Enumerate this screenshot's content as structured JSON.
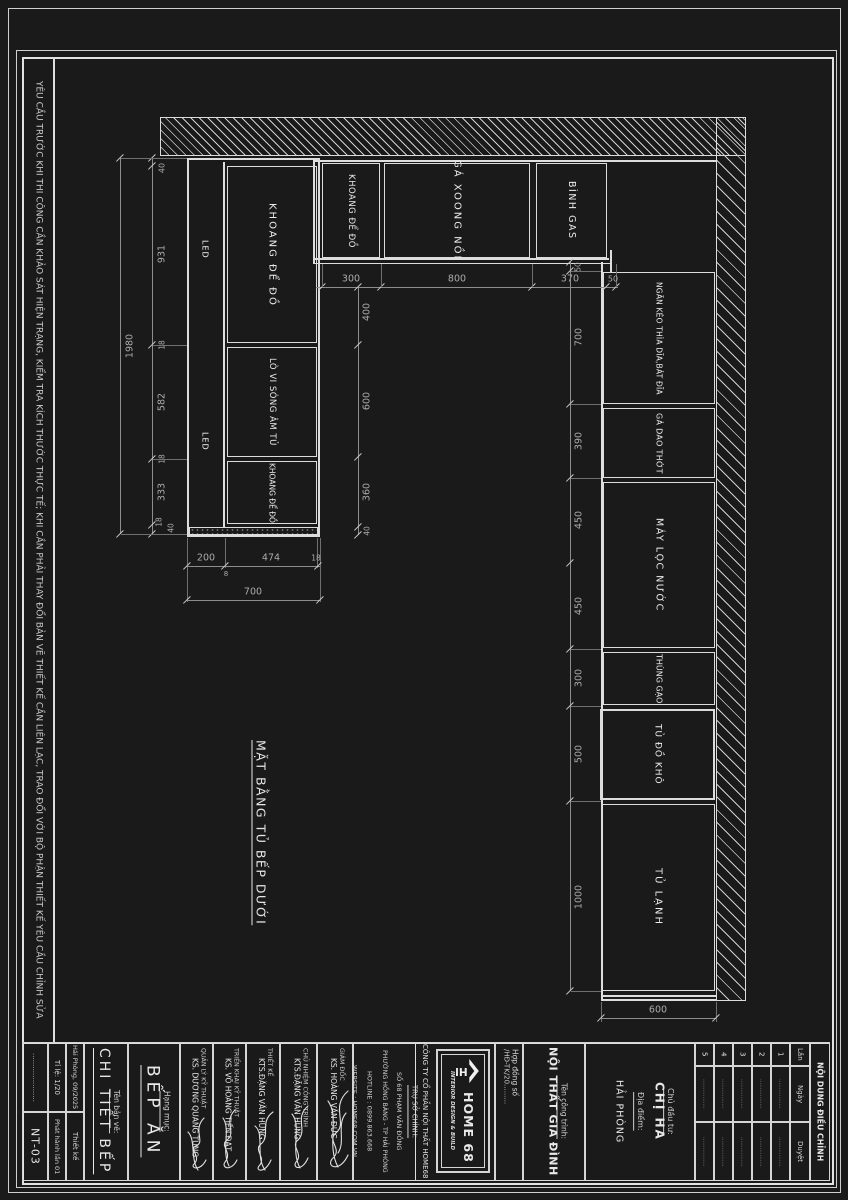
{
  "sheet": {
    "margin_note": "YÊU CẦU TRƯỚC KHI THI CÔNG CẦN KHẢO SÁT HIỆN TRẠNG, KIỂM TRA  KÍCH THƯỚC THỰC TẾ; KHI CẦN PHẢI THAY ĐỔI BẢN VẼ THIẾT KẾ CẦN LIÊN LẠC, TRAO ĐỔI VỚI BỘ PHẬN THIẾT KẾ YÊU CẦU CHỈNH SỬA",
    "drawing_title": "MẶT BẰNG TỦ BẾP DƯỚI"
  },
  "cabinets": {
    "top_row": [
      "KHOANG ĐỂ ĐỒ",
      "GÁ XOONG NỒI",
      "BÌNH GAS"
    ],
    "left_block": [
      "KHOANG ĐỂ ĐỒ",
      "LÒ VI SÓNG ÂM TỦ",
      "KHOANG ĐỂ ĐỒ"
    ],
    "led": "LED",
    "right_col": [
      "NGĂN KÉO THÌA DĨA,BÁT ĐĨA",
      "GÁ DAO THỚT",
      "MÁY LỌC NƯỚC",
      "THÙNG GẠO",
      "TỦ ĐỒ KHÔ",
      "TỦ LẠNH"
    ]
  },
  "dims": {
    "top": [
      "300",
      "800",
      "370",
      "50"
    ],
    "left_total": "1980",
    "left_chain": [
      "40",
      "931",
      "18",
      "582",
      "18",
      "333",
      "18",
      "40"
    ],
    "mid_chain": [
      "400",
      "600",
      "360",
      "40"
    ],
    "right_chain": [
      "50",
      "700",
      "390",
      "450",
      "450",
      "300",
      "500",
      "1000"
    ],
    "left_bottom": [
      "200",
      "8",
      "474",
      "18"
    ],
    "left_bottom_total": "700",
    "bottom_right": "600"
  },
  "titleblock": {
    "sheet_no": "NT-03",
    "dots_cell": "......................",
    "scale": "Tỉ lệ: 1/20",
    "issue": "Phát hành lần 01",
    "place_date": "Hải Phòng, 09/2025",
    "design_word": "Thiết kế",
    "drawing_name_label": "Tên bản vẽ:",
    "drawing_name": "CHI TIẾT BẾP",
    "category_label": "Hạng mục:",
    "category": "BẾP ĂN",
    "roles": [
      {
        "role": "QUẢN LÝ KỸ THUẬT",
        "name": "KS. DƯƠNG QUANG TÙNG"
      },
      {
        "role": "TRIỂN KHAI KỸ THUẬT",
        "name": "KS. VÕ HOÀNG TIẾN ĐẠT"
      },
      {
        "role": "THIẾT KẾ",
        "name": "KTS.ĐẶNG VĂN HÙNG"
      },
      {
        "role": "CHỦ NHIỆM CÔNG TRÌNH",
        "name": "KTS.ĐẶNG VĂN HÙNG"
      },
      {
        "role": "GIÁM ĐỐC",
        "name": "KS. HOÀNG VĂN ĐỨC"
      }
    ],
    "company": {
      "hq_label": "TRỤ SỞ CHÍNH:",
      "address1": "SỐ 68 PHẠM VĂN ĐỒNG",
      "address2": "PHƯỜNG HỒNG BÀNG - TP HẢI PHÒNG",
      "hotline": "HOTLINE : 0899.863.668",
      "website": "WEBSITE : HOME68.COM.VN",
      "name": "CÔNG TY CỔ PHẦN NỘI THẤT HOME68",
      "logo_mark": "HN",
      "logo_text": "HOME 68",
      "logo_sub": "INTERIOR DESIGN & BUILD"
    },
    "contract_label": "Hợp đồng số",
    "contract_value": "/HĐ-TK/20.........",
    "project_label": "Tên công trình:",
    "project_name": "NỘI THẤT GIA ĐÌNH",
    "client_label": "Chủ đầu tư:",
    "client_name": "CHỊ HA",
    "location_label": "Địa điểm:",
    "location": "HẢI PHÒNG",
    "revisions": {
      "title": "NỘI DUNG ĐIỀU CHỈNH",
      "col_lan": "Lần",
      "col_ngay": "Ngày",
      "col_duyet": "Duyệt",
      "rows": [
        "1",
        "2",
        "3",
        "4",
        "5"
      ],
      "dots": "................."
    }
  }
}
